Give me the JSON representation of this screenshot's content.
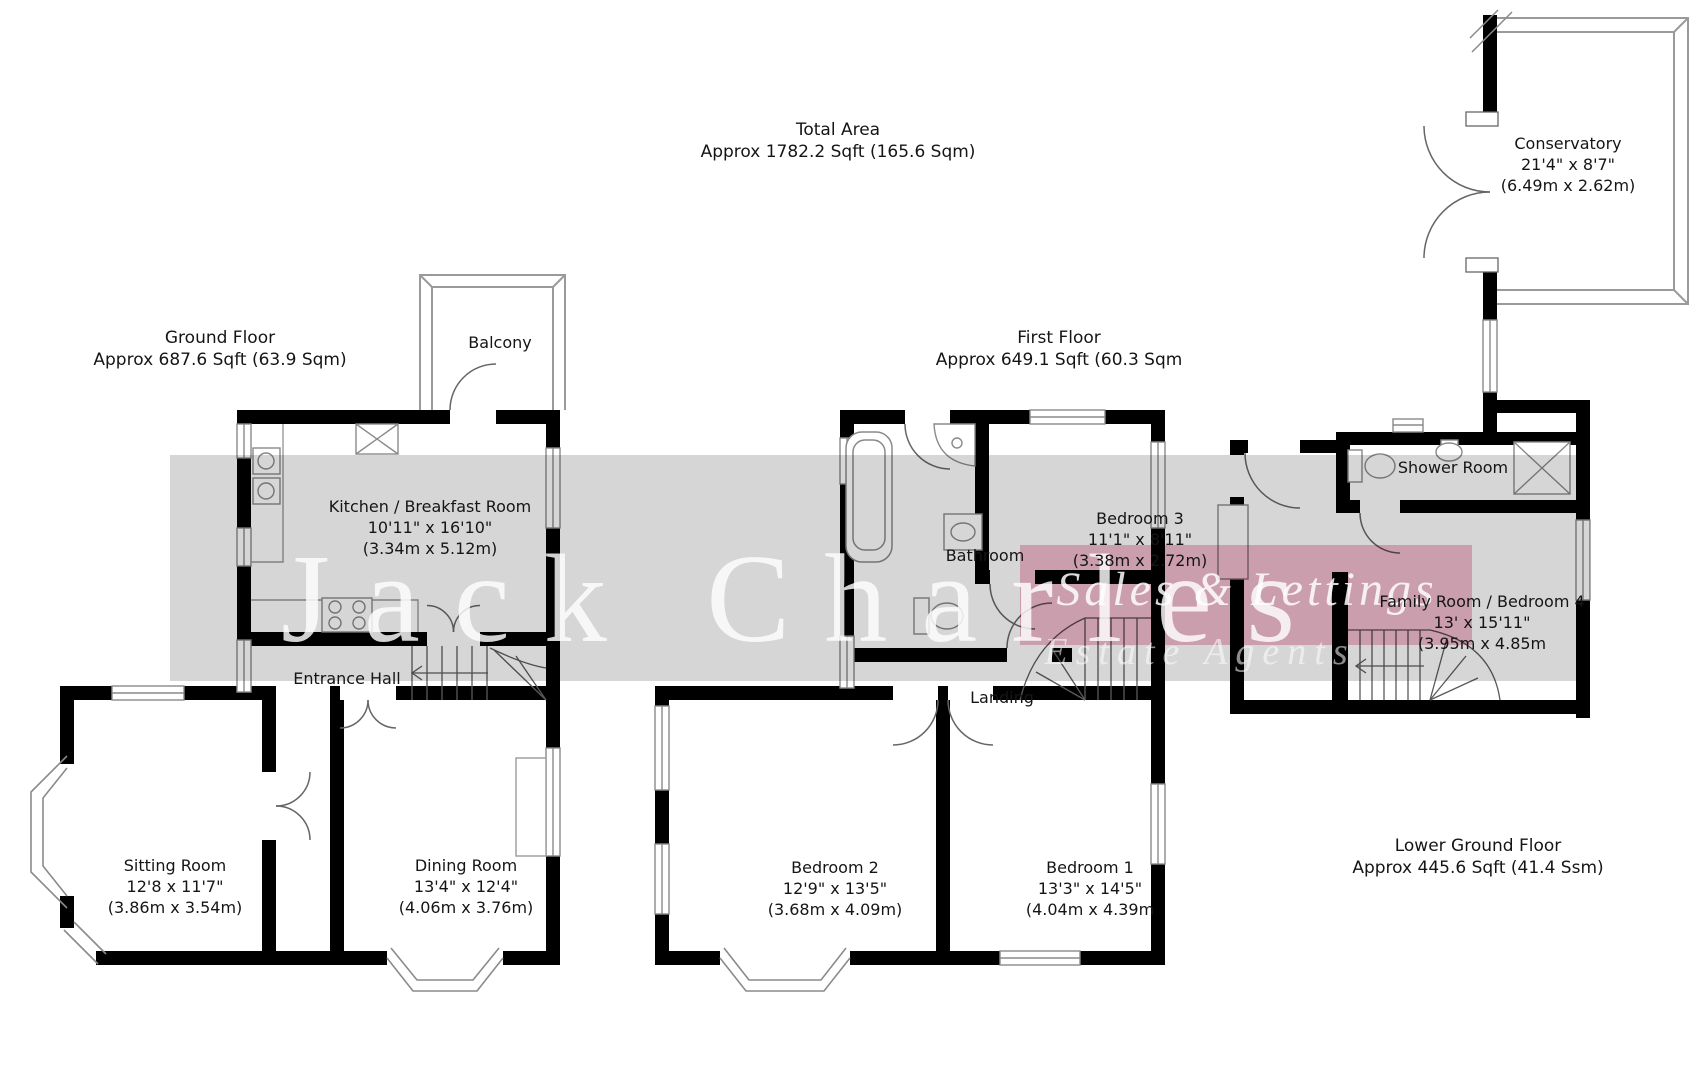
{
  "title": {
    "line1": "Total Area",
    "line2": "Approx 1782.2 Sqft (165.6 Sqm)"
  },
  "floors": {
    "ground": {
      "name": "Ground Floor",
      "area": "Approx 687.6 Sqft  (63.9 Sqm)"
    },
    "first": {
      "name": "First Floor",
      "area": "Approx 649.1 Sqft (60.3 Sqm"
    },
    "lower": {
      "name": "Lower Ground Floor",
      "area": "Approx 445.6 Sqft (41.4 Ssm)"
    }
  },
  "rooms": {
    "balcony": {
      "name": "Balcony"
    },
    "kitchen": {
      "name": "Kitchen / Breakfast Room",
      "dims": "10'11\" x 16'10\"",
      "metric": "(3.34m x 5.12m)"
    },
    "entrance_hall": {
      "name": "Entrance Hall"
    },
    "sitting": {
      "name": "Sitting Room",
      "dims": "12'8 x 11'7\"",
      "metric": "(3.86m x 3.54m)"
    },
    "dining": {
      "name": "Dining Room",
      "dims": "13'4\" x 12'4\"",
      "metric": "(4.06m x 3.76m)"
    },
    "bathroom": {
      "name": "Bathroom"
    },
    "bedroom3": {
      "name": "Bedroom 3",
      "dims": "11'1\" x 8'11\"",
      "metric": "(3.38m x 2.72m)"
    },
    "landing": {
      "name": "Landing"
    },
    "bedroom2": {
      "name": "Bedroom 2",
      "dims": "12'9\" x 13'5\"",
      "metric": "(3.68m x 4.09m)"
    },
    "bedroom1": {
      "name": "Bedroom 1",
      "dims": "13'3\" x 14'5\"",
      "metric": "(4.04m x 4.39m"
    },
    "conservatory": {
      "name": "Conservatory",
      "dims": "21'4\" x 8'7\"",
      "metric": "(6.49m x 2.62m)"
    },
    "shower": {
      "name": "Shower Room"
    },
    "family": {
      "name": "Family Room / Bedroom 4",
      "dims": "13' x 15'11\"",
      "metric": "(3.95m x 4.85m"
    }
  },
  "watermark": {
    "brand": "Jack Charles",
    "tagline": "Estate Agents",
    "banner": "Sales & Lettings",
    "grey": "#d6d6d6",
    "pink": "#f2bdd0"
  }
}
